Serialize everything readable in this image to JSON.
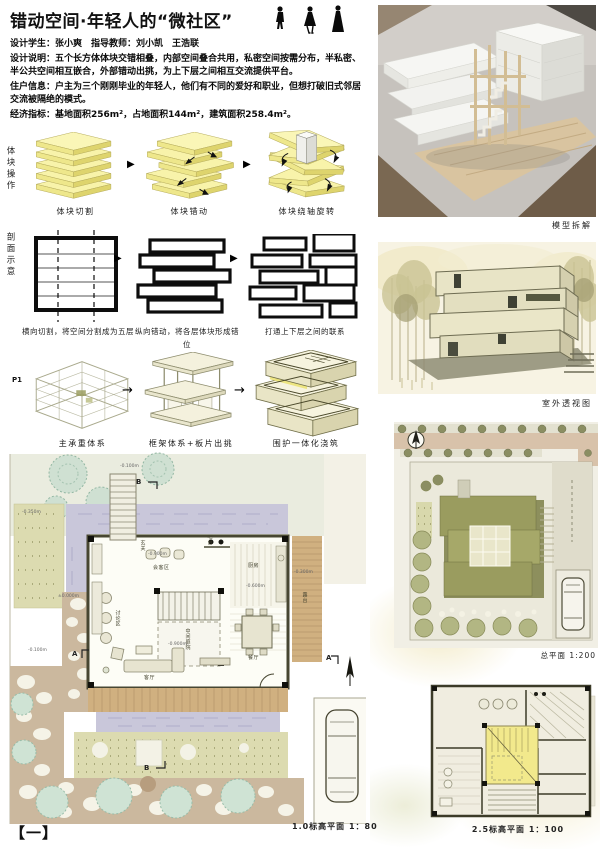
{
  "header": {
    "title": "错动空间·年轻人的“微社区”",
    "lines": [
      "设计学生：张小爽　指导教师：刘小凯　王浩联",
      "设计说明：五个长方体体块交错相叠，内部空间叠合共用，私密空间按需分布，半私密、半公共空间相互嵌合，外部错动出挑，为上下层之间相互交流提供平台。",
      "住户信息：户主为三个刚刚毕业的年轻人，他们有不同的爱好和职业，但想打破旧式邻居交流被隔绝的模式。",
      "经济指标：基地面积256m²，占地面积144m²，建筑面积258.4m²。"
    ]
  },
  "massing": {
    "side_label": "体块操作",
    "steps": [
      "体块切割",
      "体块错动",
      "体块绕轴旋转"
    ]
  },
  "sections": {
    "side_label": "剖面示意",
    "captions": [
      "横向切割，将空间分割成为五层",
      "纵向错动，将各层体块形成错位",
      "打通上下层之间的联系"
    ]
  },
  "structure": {
    "p_label": "P1",
    "steps": [
      "主承重体系",
      "框架体系+板片出挑",
      "围护一体化浇筑"
    ]
  },
  "right_column": {
    "model_label": "模型拆解",
    "perspective_label": "室外透视图",
    "site_plan_label": "总平面 1:200",
    "upper_plan_label": "2.5标高平面 1：100"
  },
  "ground_plan": {
    "label": "1.0标高平面 1：80",
    "rooms": {
      "entry": "玄关",
      "reception": "会客区",
      "bar": "吧台",
      "kitchen": "厨房",
      "courtyard": "中间庭院",
      "discussion": "讨论区",
      "dining": "餐厅",
      "living": "客厅",
      "terrace": "露台"
    },
    "levels": {
      "zero": "±0.000m",
      "m900": "-0.900m",
      "m600": "-0.600m",
      "m300": "-0.300m",
      "m100": "-0.100m",
      "m350": "-0.350m"
    },
    "marks": {
      "b": "B",
      "a": "A"
    }
  },
  "icons": {
    "arrow_solid": "▶",
    "arrow_thin": "→"
  },
  "page_number": "【一】",
  "colors": {
    "accent_yellow": "#f6ef9e",
    "olive": "#8f9150",
    "water_lavender": "#c9c7da",
    "deck_tan": "#d0b080",
    "ink": "#111111"
  }
}
